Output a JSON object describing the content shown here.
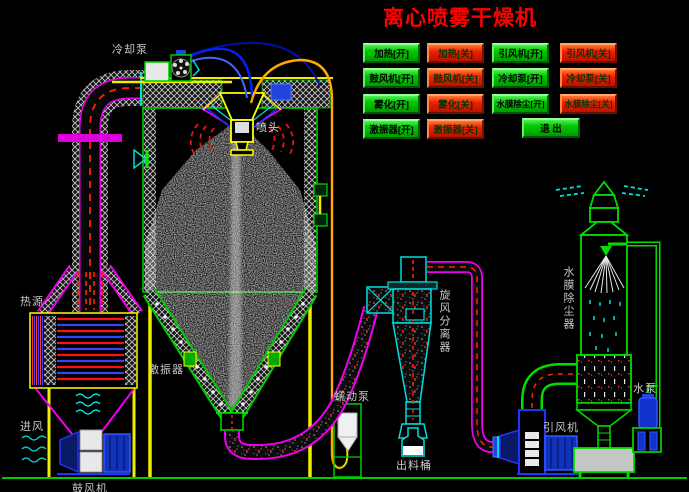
{
  "title": "离心喷雾干燥机",
  "control_panel": {
    "buttons": [
      {
        "label": "加热[开]",
        "state": "on"
      },
      {
        "label": "加热[关]",
        "state": "off"
      },
      {
        "label": "引风机[开]",
        "state": "on"
      },
      {
        "label": "引风机[关]",
        "state": "off"
      },
      {
        "label": "鼓风机[开]",
        "state": "on"
      },
      {
        "label": "鼓风机[关]",
        "state": "off"
      },
      {
        "label": "冷却泵[开]",
        "state": "on"
      },
      {
        "label": "冷却泵[关]",
        "state": "off"
      },
      {
        "label": "雾化[开]",
        "state": "on"
      },
      {
        "label": "雾化[关]",
        "state": "off"
      },
      {
        "label": "水膜除尘[开]",
        "state": "on"
      },
      {
        "label": "水膜除尘[关]",
        "state": "off"
      },
      {
        "label": "激振器[开]",
        "state": "on"
      },
      {
        "label": "激振器[关]",
        "state": "off"
      }
    ],
    "exit_label": "退 出"
  },
  "equipment_labels": {
    "cooling_pump": "冷却泵",
    "spray_head": "喷头",
    "heat_source": "热源",
    "air_inlet": "进风",
    "blower": "鼓风机",
    "vibrator": "激振器",
    "peristaltic_pump": "蠕动泵",
    "discharge_barrel": "出料桶",
    "cyclone_separator": "旋风分离器",
    "water_film_dust_collector": "水膜除尘器",
    "induced_draft_fan": "引风机",
    "water_pump": "水泵"
  },
  "colors": {
    "on_button_green": "#00CC00",
    "off_button_red": "#EE2200",
    "title_red": "#FF0000",
    "pipe_magenta": "#EE00EE",
    "structure_green": "#00DD00",
    "label_gray": "#C9C9C9"
  }
}
